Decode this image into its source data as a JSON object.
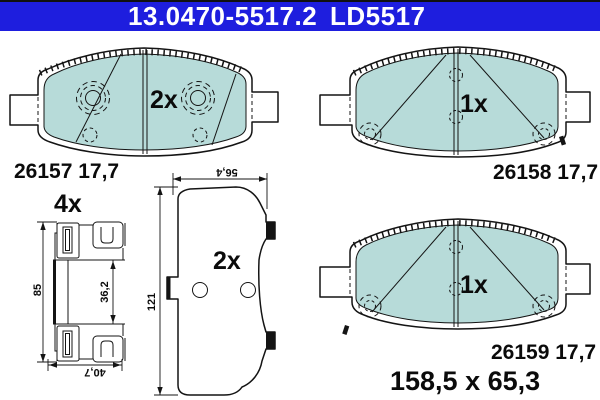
{
  "header": {
    "part_number": "13.0470-5517.2",
    "code": "LD5517",
    "bg": "#1E1EDE",
    "text_color": "#FFFFFF"
  },
  "colors": {
    "friction": "#B7DBD9",
    "line": "#141414",
    "background": "#FFFFFF"
  },
  "pads": {
    "top_left": {
      "qty": "2x",
      "label": "26157 17,7"
    },
    "top_right": {
      "qty": "1x",
      "label": "26158 17,7"
    },
    "bottom_right": {
      "qty": "1x",
      "label": "26159 17,7",
      "size": "158,5 x 65,3"
    }
  },
  "backplate": {
    "qty": "2x",
    "dim_width": "56,4",
    "dim_height": "121"
  },
  "hardware_clip": {
    "qty": "4x",
    "dim_height": "85",
    "dim_inner": "36,2",
    "dim_width": "40,7"
  }
}
